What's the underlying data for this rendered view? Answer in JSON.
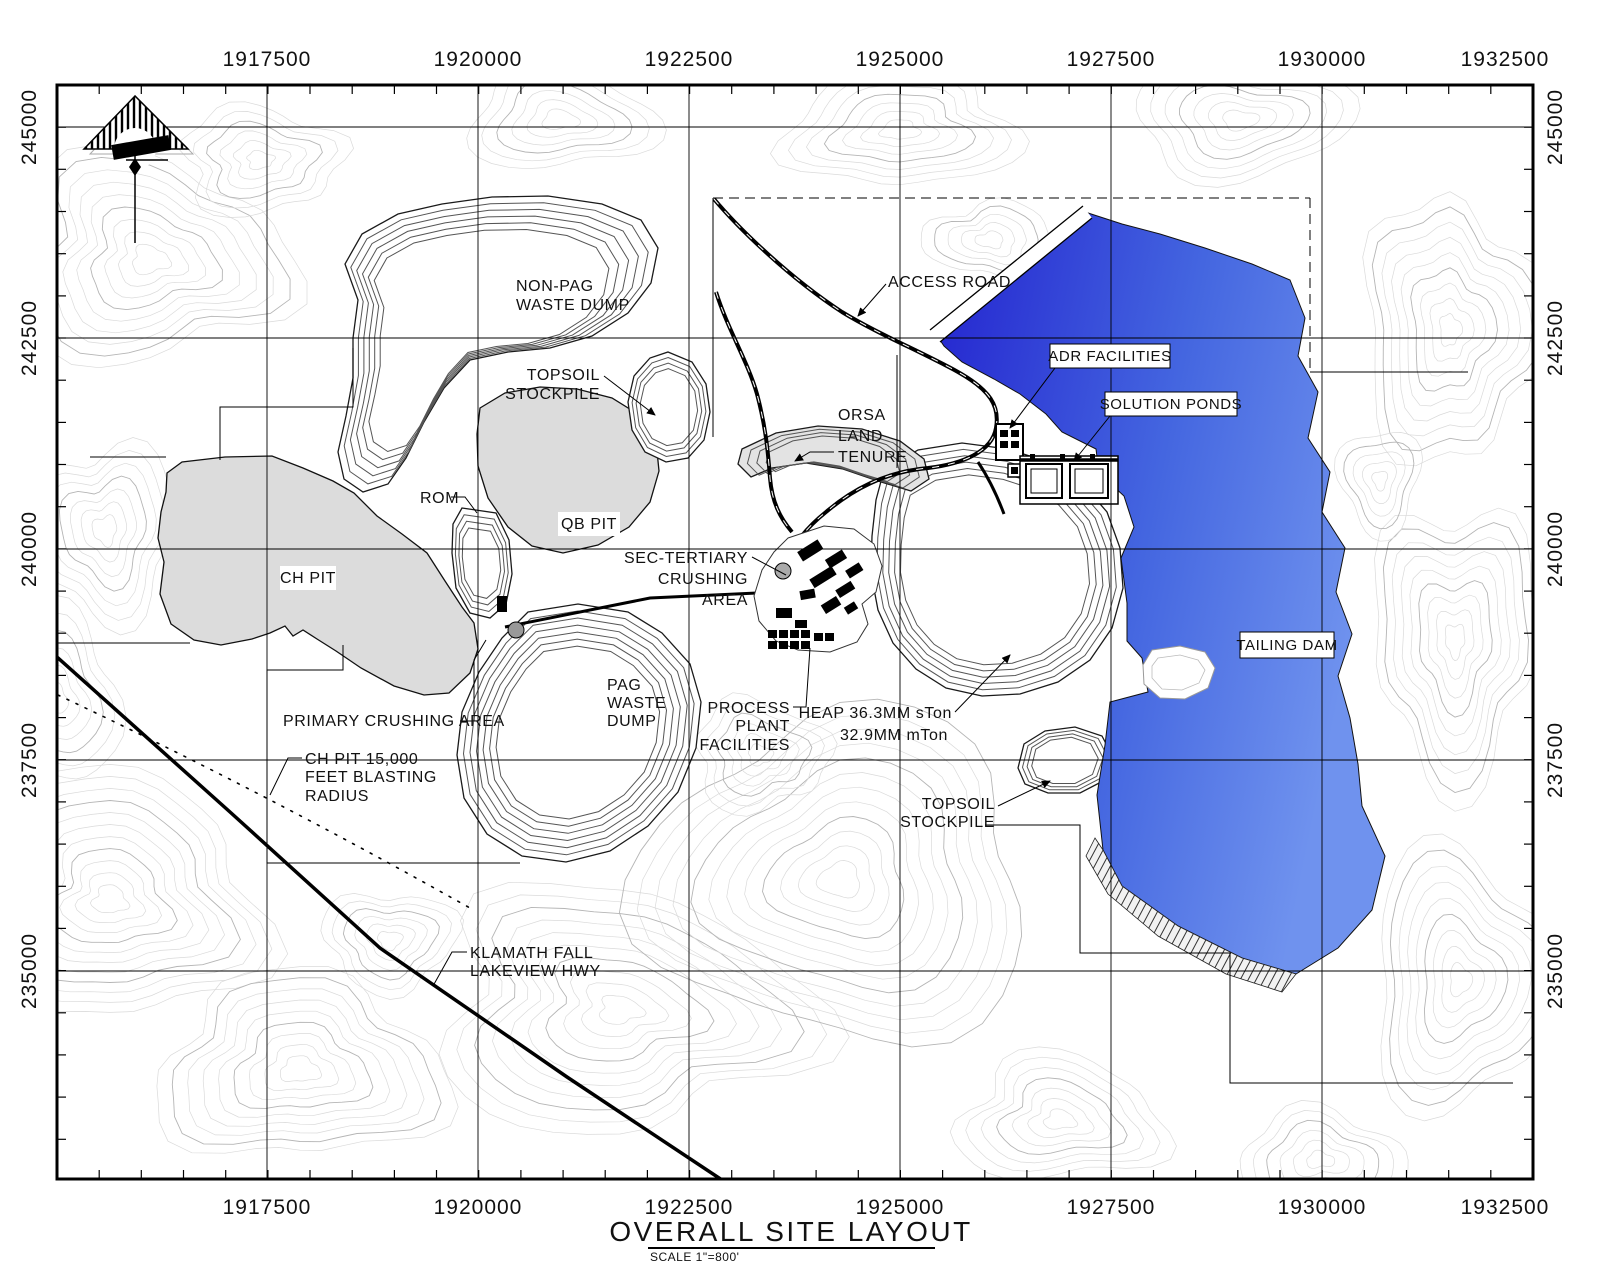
{
  "frame": {
    "title": "OVERALL SITE LAYOUT",
    "scale_note": "SCALE  1\"=800'",
    "x_axis_labels": [
      "1917500",
      "1920000",
      "1922500",
      "1925000",
      "1927500",
      "1930000",
      "1932500"
    ],
    "y_axis_labels": [
      "245000",
      "242500",
      "240000",
      "237500",
      "235000"
    ]
  },
  "labels": {
    "non_pag": [
      "NON-PAG",
      "WASTE DUMP"
    ],
    "topsoil_nw": [
      "TOPSOIL",
      "STOCKPILE"
    ],
    "access_road": "ACCESS ROAD",
    "adr": "ADR FACILITIES",
    "solution_ponds": "SOLUTION PONDS",
    "orsa": [
      "ORSA",
      "LAND",
      "TENURE"
    ],
    "rom": "ROM",
    "qb_pit": "QB PIT",
    "ch_pit": "CH PIT",
    "sec_tertiary": [
      "SEC-TERTIARY",
      "CRUSHING",
      "AREA"
    ],
    "tailing_dam": "TAILING DAM",
    "pag": [
      "PAG",
      "WASTE",
      "DUMP"
    ],
    "primary_crushing": "PRIMARY CRUSHING AREA",
    "blasting": [
      "CH PIT 15,000",
      "FEET BLASTING",
      "RADIUS"
    ],
    "process_plant": [
      "PROCESS",
      "PLANT",
      "FACILITIES"
    ],
    "heap": [
      "HEAP 36.3MM sTon",
      "32.9MM mTon"
    ],
    "topsoil_se": [
      "TOPSOIL",
      "STOCKPILE"
    ],
    "highway": [
      "KLAMATH FALL",
      "LAKEVIEW HWY"
    ]
  },
  "colors": {
    "water_dark": "#2a2ad2",
    "water_light": "#6c8cec",
    "pit_gray": "#dcdcdc",
    "contour_minor": "#dadada",
    "contour_index": "#b5b5b5"
  }
}
